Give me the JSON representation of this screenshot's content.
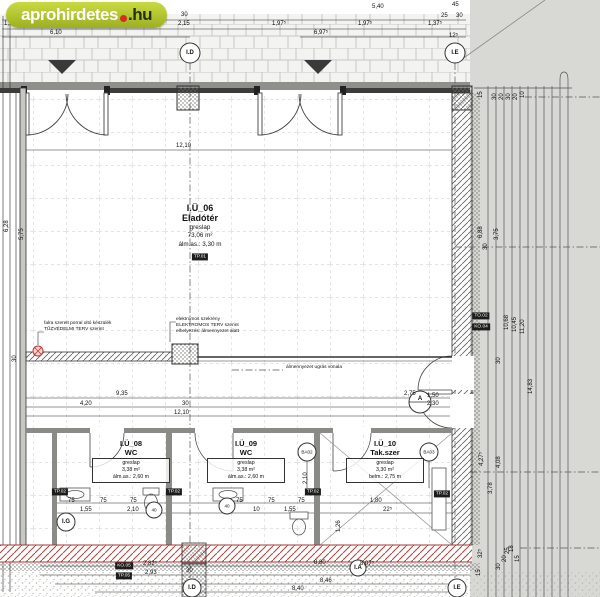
{
  "watermark": {
    "brand": "aprohirdetes",
    "suffix": ".hu"
  },
  "colors": {
    "watermark_green": "#aec32d",
    "watermark_red": "#d92b1f",
    "wall_hatch_red": "#b5413c"
  },
  "rooms": {
    "main": {
      "id": "I.Ü_06",
      "name": "Eladótér",
      "material": "greslap",
      "area": "73,06 m²",
      "height": "álm.as.: 3,30 m",
      "badge": "TP.01"
    },
    "wc1": {
      "id": "I.Ü_08",
      "name": "WC",
      "material": "greslap",
      "area": "3,38 m²",
      "height": "álm.as.: 2,60 m"
    },
    "wc2": {
      "id": "I.Ü_09",
      "name": "WC",
      "material": "greslap",
      "area": "3,38 m²",
      "height": "álm.as.: 2,60 m"
    },
    "tak": {
      "id": "I.Ü_10",
      "name": "Tak.szer",
      "material": "greslap",
      "area": "3,30 m²",
      "height": "belm.: 2,75 m"
    }
  },
  "markers": {
    "top_d": "I.D",
    "top_e": "I.E",
    "bot_d": "I.D",
    "bot_e": "I.E",
    "left_g": "I.G",
    "mid_a": "I.A",
    "sect_a": "A",
    "ba02": "BA02",
    "ba03": "BA03",
    "f40a": "40",
    "f40b": "40"
  },
  "badges": {
    "tp01": "TP.01",
    "tp02a": "TP.02",
    "tp02b": "TP.02",
    "tp02c": "TP.02",
    "tp02d": "TP.02",
    "to02": "TO.02",
    "ko04": "KO.04",
    "ko05": "KO.05",
    "tp05": "TP.05"
  },
  "annotations": {
    "fire_line1": "falra szerelt porral oltó készülék",
    "fire_line2": "TŰZVÉDELMI TERV szerint",
    "elec_line1": "elektromos szekrény",
    "elec_line2": "ELEKTROMOS TERV szerint",
    "elec_line3": "elhelyezés: álmennyezet alatt",
    "ceiling": "álmennyezet ugrás vonala"
  },
  "dims": {
    "top": [
      "1,97⁵",
      "6,10",
      "1,97⁵",
      "30",
      "2,15",
      "5,40",
      "1,97⁵",
      "6,97⁵",
      "1,97⁵",
      "1,37⁵",
      "45",
      "25",
      "30",
      "12⁵"
    ],
    "mid": [
      "12,10"
    ],
    "corridor": [
      "9,35",
      "4,20",
      "30",
      "12,10",
      "2,75",
      "1,50",
      "2,30"
    ],
    "small": [
      "75",
      "75",
      "75",
      "1,55",
      "2,10",
      "75",
      "75",
      "75",
      "10",
      "1,55",
      "1,80",
      "22⁵",
      "1,26",
      "2,10"
    ],
    "bottom": [
      "2,82⁵",
      "2,93",
      "30",
      "8,80",
      "8,07⁵",
      "8,46",
      "8,40"
    ],
    "left": [
      "6,28",
      "5,75",
      "30"
    ],
    "right": [
      "15",
      "30",
      "20",
      "30",
      "20",
      "10",
      "6,88",
      "3,75",
      "30",
      "10,68",
      "10,45",
      "11,20",
      "30",
      "14,83",
      "4,27⁵",
      "4,08",
      "3,78",
      "32⁵",
      "15",
      "30",
      "20",
      "25",
      "18",
      "15"
    ]
  }
}
